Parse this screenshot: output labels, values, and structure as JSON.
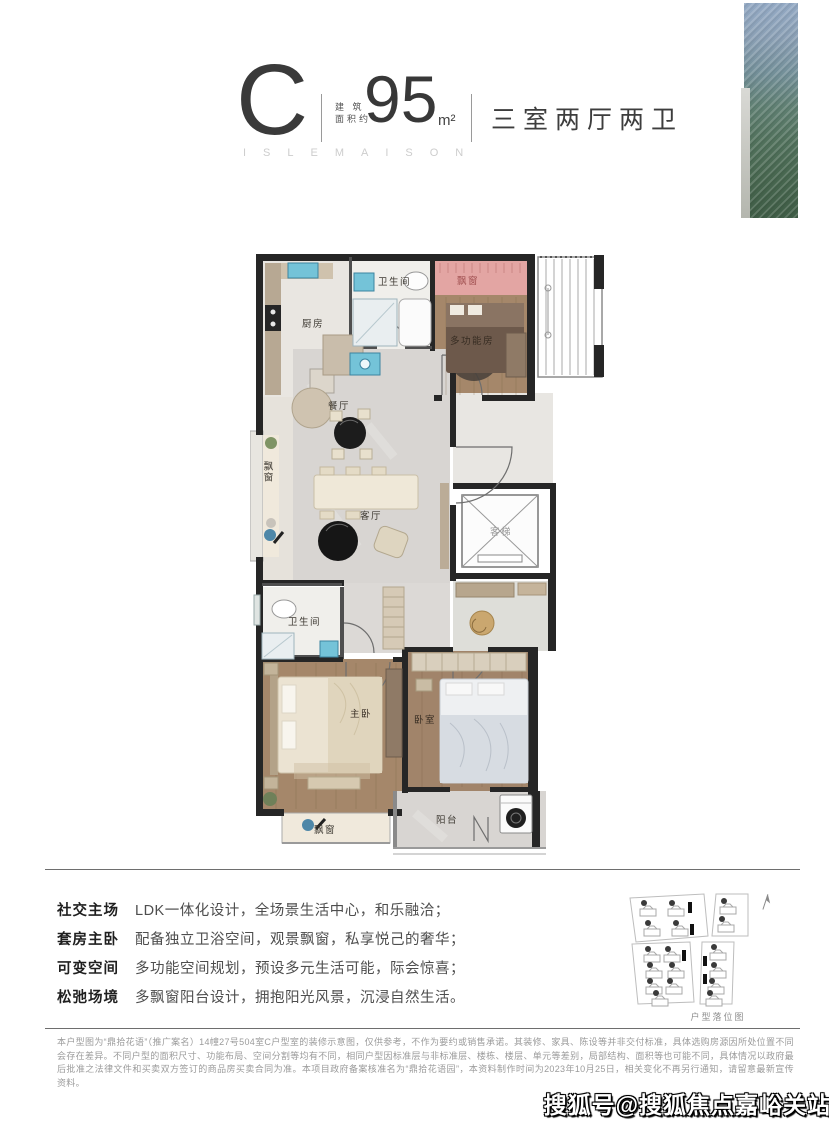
{
  "header": {
    "unit_letter": "C",
    "area_label_top": "建 筑",
    "area_label_bottom": "面积约",
    "area_value": "95",
    "area_unit": "m²",
    "layout": "三室两厅两卫",
    "brand": "ISLEMAISON"
  },
  "plan": {
    "labels": {
      "kitchen": "厨房",
      "bath_top": "卫生间",
      "bay_top": "飘窗",
      "multi_room": "多功能房",
      "dining": "餐厅",
      "bay_left": "飘窗",
      "living": "客厅",
      "elevator": "客梯",
      "bath_bottom": "卫生间",
      "master": "主卧",
      "bedroom": "卧室",
      "bay_bottom": "飘窗",
      "balcony": "阳台"
    }
  },
  "features": [
    {
      "label": "社交主场",
      "desc": "LDK一体化设计，全场景生活中心，和乐融洽；"
    },
    {
      "label": "套房主卧",
      "desc": "配备独立卫浴空间，观景飘窗，私享悦己的奢华；"
    },
    {
      "label": "可变空间",
      "desc": "多功能空间规划，预设多元生活可能，际会惊喜；"
    },
    {
      "label": "松弛场境",
      "desc": "多飘窗阳台设计，拥抱阳光风景，沉浸自然生活。"
    }
  ],
  "site_map": {
    "caption": "户型落位图"
  },
  "disclaimer": "本户型图为“鼎拾花语”（推广案名）14幢27号504室C户型室的装修示意图，仅供参考，不作为要约或销售承诺。其装修、家具、陈设等并非交付标准，具体选购房源因所处位置不同会存在差异。不同户型的面积尺寸、功能布局、空间分割等均有不同，相同户型因标准层与非标准层、楼栋、楼层、单元等差别，局部结构、面积等也可能不同，具体情况以政府最后批准之法律文件和买卖双方签订的商品房买卖合同为准。本项目政府备案核准名为“鼎拾花语园”，本资料制作时间为2023年10月25日，相关变化不再另行通知，请留意最新宣传资料。",
  "watermark": "搜狐号@搜狐焦点嘉峪关站",
  "colors": {
    "accent_pink": "#e3a5a3",
    "glass_top": "#93a9c4",
    "glass_bottom": "#3f5d46"
  }
}
